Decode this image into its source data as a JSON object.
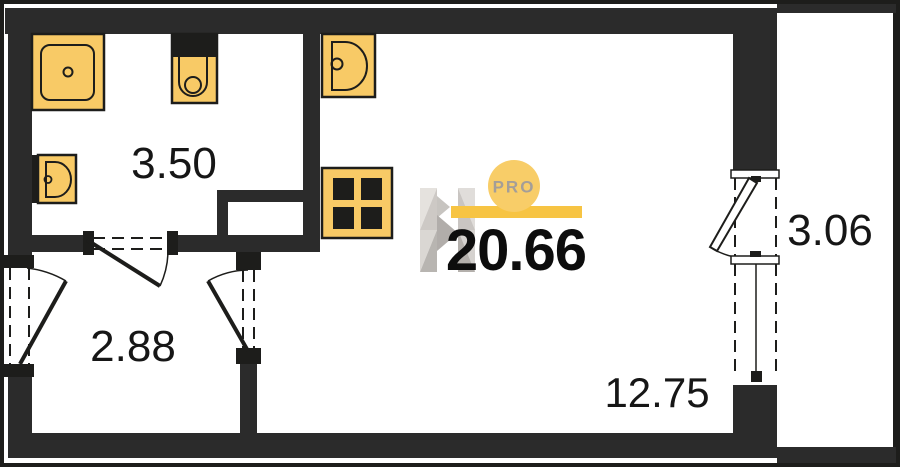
{
  "plan": {
    "total_area_label": "20.66",
    "rooms": [
      {
        "id": "bathroom",
        "area_label": "3.50"
      },
      {
        "id": "hallway",
        "area_label": "2.88"
      },
      {
        "id": "living-zone",
        "area_label": "12.75"
      },
      {
        "id": "balcony",
        "area_label": "3.06"
      }
    ],
    "watermark": {
      "badge_label": "PRO"
    },
    "fixtures": [
      {
        "icon": "shower-icon"
      },
      {
        "icon": "toilet-icon"
      },
      {
        "icon": "washbasin-icon"
      },
      {
        "icon": "kitchen-sink-icon"
      },
      {
        "icon": "stove-icon"
      }
    ],
    "colors": {
      "wall": "#2b2b2b",
      "frame": "#1d1d1b",
      "fixture_fill": "#f8ca66",
      "fixture_outline": "#1d1d1b",
      "accent_bar": "#f7c443",
      "accent_circle": "#f8cd68",
      "badge_text": "#a49e98",
      "label_text": "#161616"
    }
  }
}
